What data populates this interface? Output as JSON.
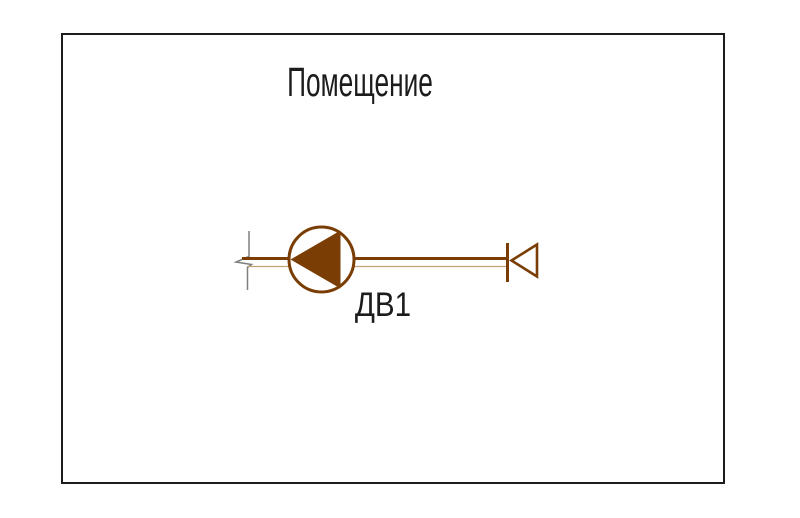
{
  "drawing": {
    "room_label": "Помещение",
    "fan_label": "ДВ1",
    "colors": {
      "duct_brown": "#7a3e04",
      "duct_thin_tan": "#c2a078",
      "break_gray": "#808080",
      "frame_black": "#1c1c1c",
      "fill_white": "#ffffff"
    },
    "icons": {
      "fan_icon": "circle-with-filled-left-triangle",
      "air_valve_icon": "stop-bar-with-open-left-triangle",
      "duct_break_icon": "gray-zigzag-break-line"
    }
  }
}
